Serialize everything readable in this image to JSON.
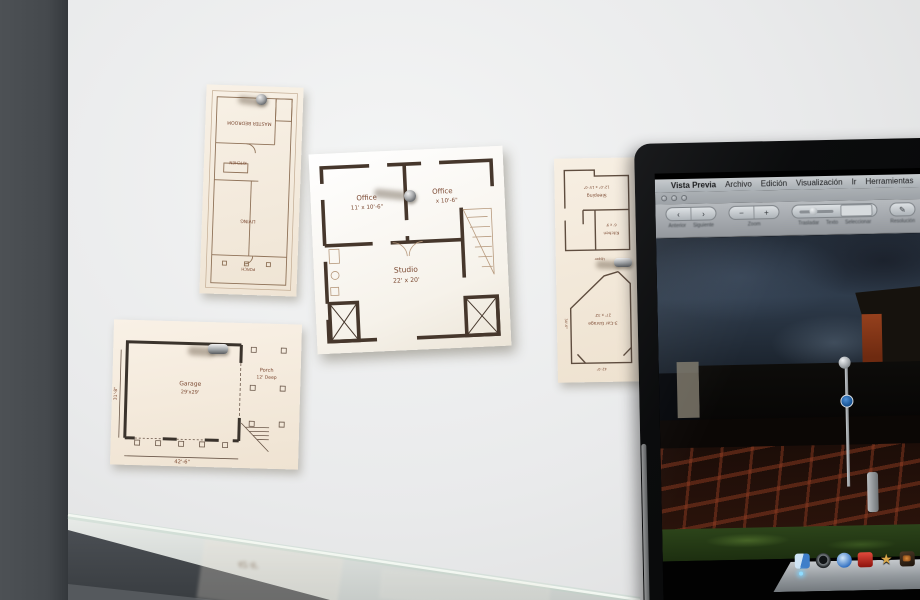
{
  "colors": {
    "wall": "#e9eaeb",
    "wall_corner": "#45494d",
    "paper_sepia": "#f6eee2",
    "paper_white": "#ffffff",
    "plan_ink": "#7c4a33",
    "plan_wall": "#46372c",
    "laptop_bezel": "#0b0c0d",
    "menubar_grey": "#b8bcc0",
    "sign_blue": "#1f66b0",
    "brick_red": "#8c3a20",
    "grass_green": "#2c441a"
  },
  "plans": {
    "cottage": {
      "note_icon": "pushpin-icon",
      "rooms": [
        {
          "name": "MASTER BEDROOM"
        },
        {
          "name": "KITCHEN"
        },
        {
          "name": "LIVING"
        },
        {
          "name": "PORCH"
        }
      ]
    },
    "studio": {
      "note_icon": "pushpin-icon",
      "rooms": [
        {
          "name": "Office",
          "dims": "11' x 10'-6\""
        },
        {
          "name": "Office",
          "dims": "x 10'-6\""
        },
        {
          "name": "Studio",
          "dims": "22' x 20'"
        }
      ]
    },
    "garage": {
      "note_icon": "pushpin-icon",
      "rooms": [
        {
          "name": "Garage",
          "dims": "29'x29'"
        },
        {
          "name": "Porch",
          "dims": "12' Deep"
        }
      ],
      "dim_bottom": "42'-6\"",
      "dim_left": "31'-8\""
    },
    "upper_garage": {
      "note_icon": "pushpin-icon",
      "rooms": [
        {
          "name": "Sleeping",
          "dims": "12'-0\" x 15'-0\""
        },
        {
          "name": "Kitchen",
          "dims": "6' x 9'"
        },
        {
          "name": "3-Car Garage",
          "dims": "27' x 32'"
        }
      ],
      "label_upper": "Upper",
      "dim_bottom": "42'-0\"",
      "dim_left": "34'-6\""
    }
  },
  "laptop": {
    "menubar": {
      "apple_icon": "apple-logo-icon",
      "items": [
        "Vista Previa",
        "Archivo",
        "Edición",
        "Visualización",
        "Ir",
        "Herramientas",
        "Favoritos",
        "Ventana"
      ]
    },
    "toolbar": {
      "glyphs": {
        "back": "‹",
        "forward": "›",
        "minus": "−",
        "plus": "+",
        "pencil": "✎"
      },
      "labels": {
        "back": "Anterior",
        "forward": "Siguiente",
        "zoom": "Zoom",
        "move": "Trasladar",
        "text": "Texto",
        "select": "Seleccionar",
        "resolution": "Resolución"
      }
    },
    "dock": {
      "icons": [
        "finder-icon",
        "media-player-icon",
        "safari-icon",
        "red-drink-icon",
        "star-icon",
        "photo-icon",
        "chat-icon"
      ],
      "star_glyph": "★"
    }
  }
}
